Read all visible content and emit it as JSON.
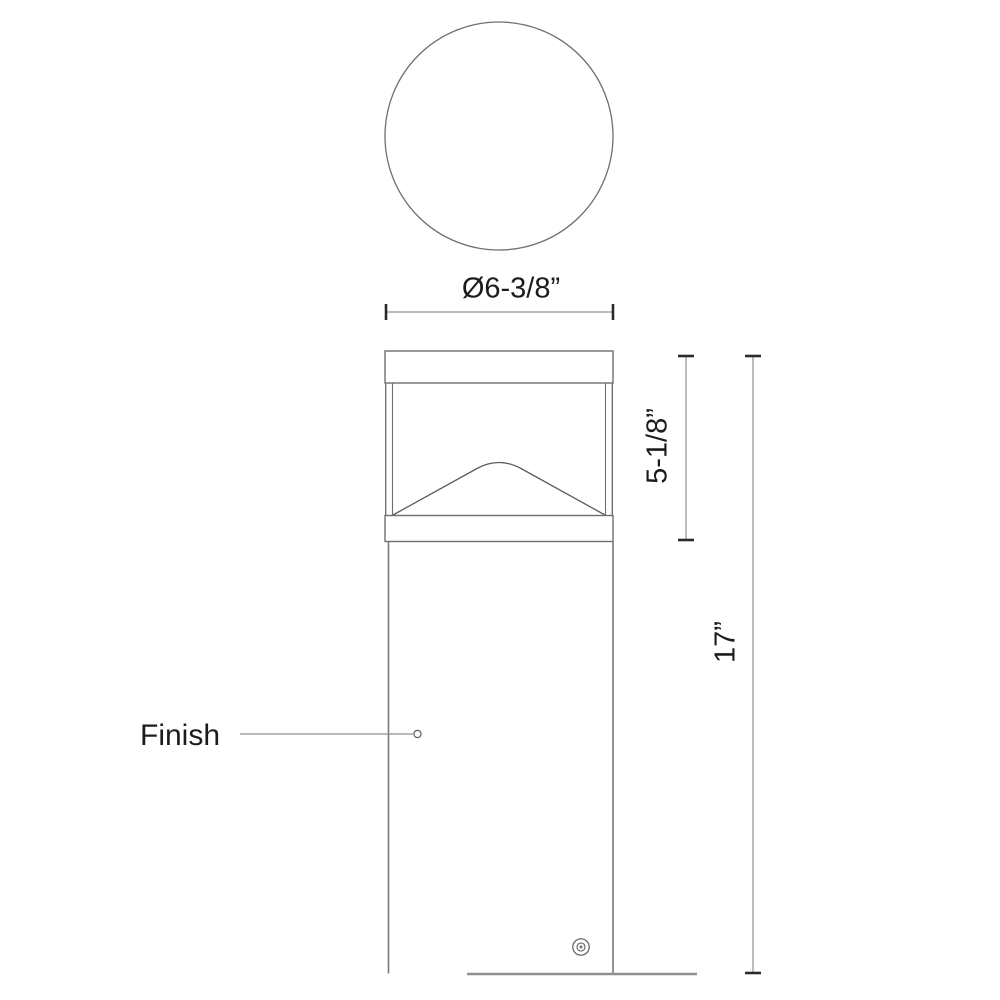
{
  "diagram": {
    "type": "technical-line-drawing",
    "views": {
      "top_view": "circular-top-view",
      "front_view": "bollard-front-elevation"
    },
    "dimensions": {
      "diameter_label": "Ø6-3/8”",
      "head_height_label": "5-1/8”",
      "overall_height_label": "17”"
    },
    "callouts": {
      "finish_label": "Finish"
    },
    "colors": {
      "background": "#ffffff",
      "line": "#6f6f6f",
      "light_line": "#8f8f8f",
      "tick": "#2a2a2a",
      "text": "#1c1c1c"
    }
  }
}
